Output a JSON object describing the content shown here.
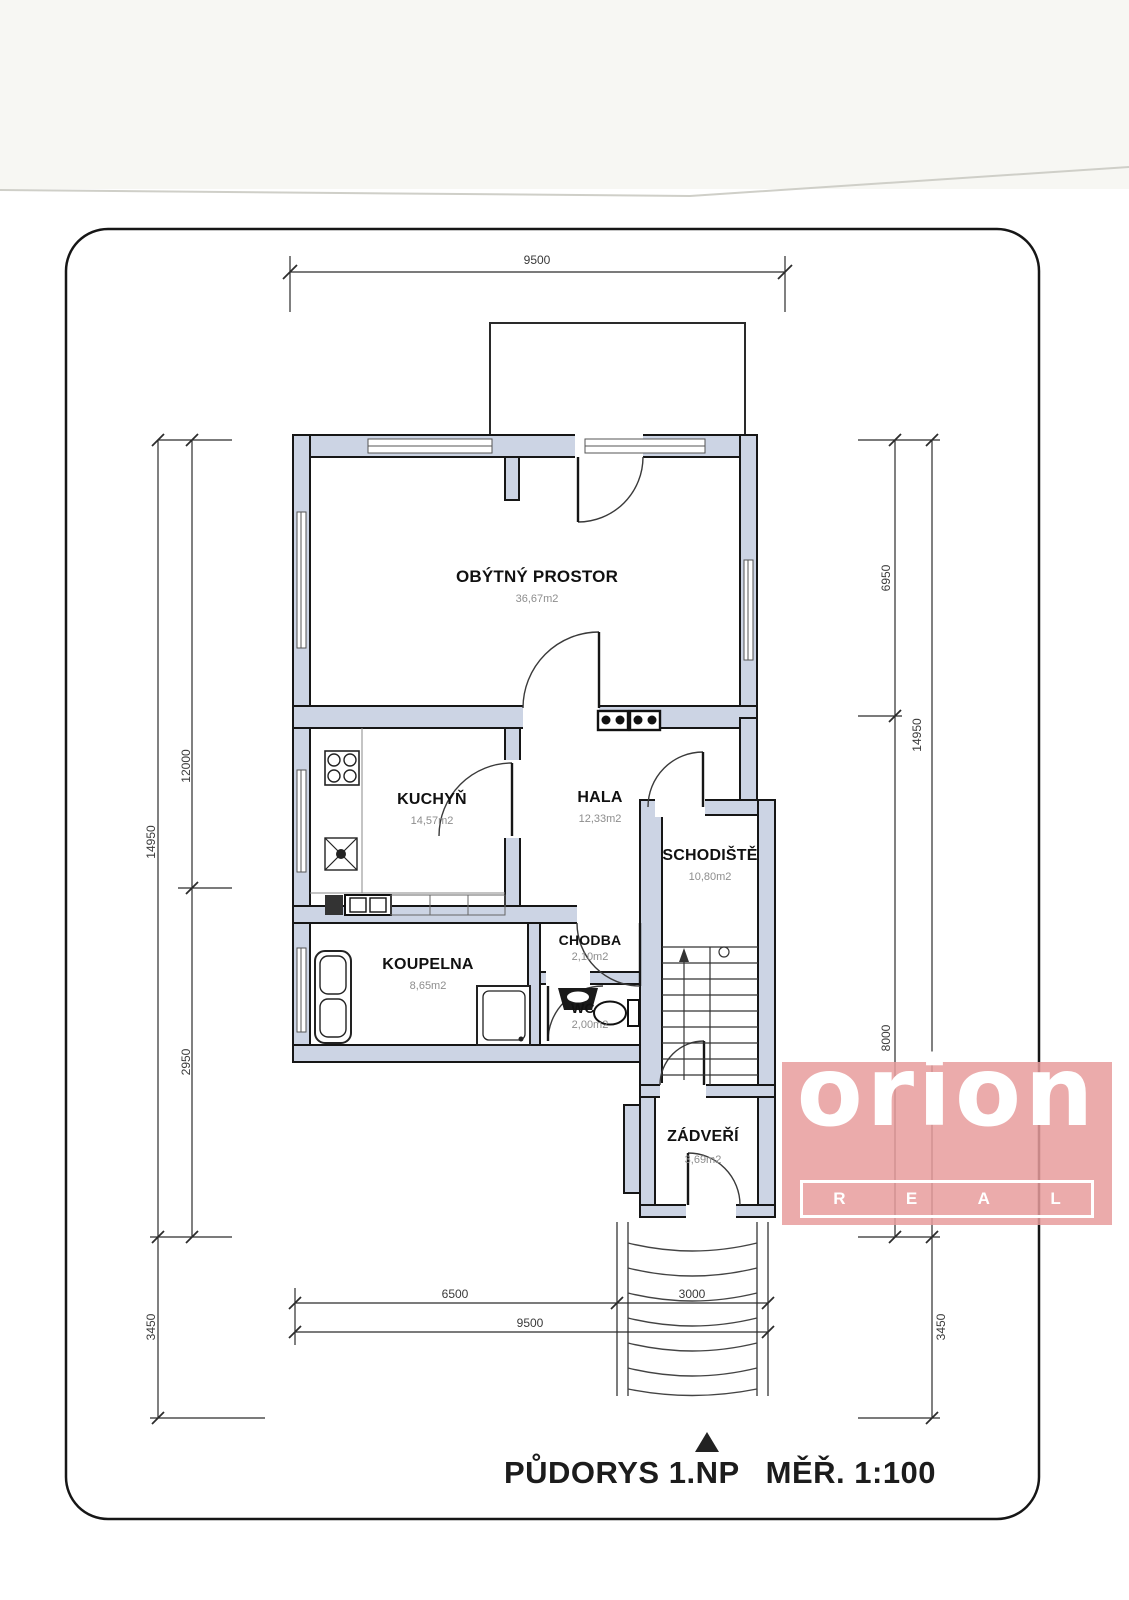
{
  "drawing": {
    "title": "PŮDORYS 1.NP",
    "scale": "MĚŘ. 1:100"
  },
  "rooms": [
    {
      "name": "OBÝTNÝ PROSTOR",
      "area": "36,67m2"
    },
    {
      "name": "KUCHYŇ",
      "area": "14,57m2"
    },
    {
      "name": "HALA",
      "area": "12,33m2"
    },
    {
      "name": "SCHODIŠTĚ",
      "area": "10,80m2"
    },
    {
      "name": "KOUPELNA",
      "area": "8,65m2"
    },
    {
      "name": "CHODBA",
      "area": "2,10m2"
    },
    {
      "name": "WC",
      "area": "2,00m2"
    },
    {
      "name": "ZÁDVEŘÍ",
      "area": "3,69m2"
    }
  ],
  "dimensions": {
    "top_width": "9500",
    "left_upper": "12000",
    "left_total": "14950",
    "left_lower": "2950",
    "left_offset": "3450",
    "right_upper": "6950",
    "right_total": "14950",
    "right_lower": "8000",
    "right_offset": "3450",
    "bottom_left": "6500",
    "bottom_right": "3000",
    "bottom_total": "9500"
  },
  "watermark": {
    "brand": "orion",
    "sub_letters": [
      "R",
      "E",
      "A",
      "L"
    ],
    "bg_color": "#e89c9c"
  },
  "colors": {
    "wall_fill": "#ccd4e4",
    "line": "#1b1b1b"
  }
}
